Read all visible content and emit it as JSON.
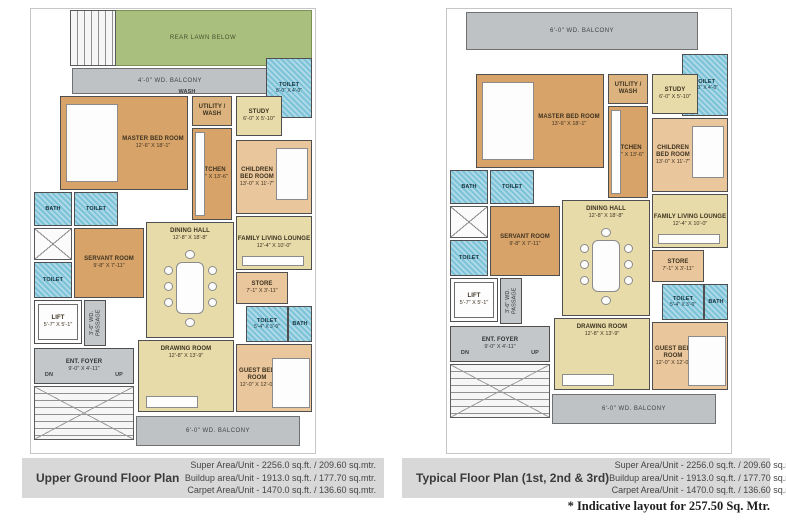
{
  "footnote": "* Indicative layout for 257.50 Sq. Mtr.",
  "colors": {
    "lawn_green": "#a9bf7d",
    "balcony_gray": "#bfc2c4",
    "bedroom_tan": "#d7a369",
    "bedroom_peach": "#eac69c",
    "living_cream": "#e6dba9",
    "toilet_blue": "#7cc2d8",
    "caption_band": "#d8d8d8"
  },
  "plans": [
    {
      "title": "Upper Ground Floor Plan",
      "super_area": "Super Area/Unit - 2256.0 sq.ft. / 209.60 sq.mtr.",
      "buildup_area": "Buildup area/Unit - 1913.0 sq.ft. / 177.70 sq.mtr.",
      "carpet_area": "Carpet Area/Unit - 1470.0 sq.ft. / 136.60 sq.mtr.",
      "rooms": {
        "rear_lawn": {
          "name": "REAR LAWN BELOW"
        },
        "balcony_top": {
          "name": "4'-0\" WD. BALCONY"
        },
        "wash": {
          "name": "WASH"
        },
        "toilet_top": {
          "name": "TOILET",
          "dims": "8'-0\" X 4'-0\""
        },
        "master_bed": {
          "name": "MASTER BED ROOM",
          "dims": "12'-6\" X 18'-1\""
        },
        "utility": {
          "name": "UTILITY / WASH"
        },
        "kitchen": {
          "name": "KITCHEN",
          "dims": "8'-0\" X 13'-6\""
        },
        "study": {
          "name": "STUDY",
          "dims": "6'-0\" X 5'-10\""
        },
        "children_bed": {
          "name": "CHILDREN BED ROOM",
          "dims": "13'-0\" X 11'-7\""
        },
        "family_lounge": {
          "name": "FAMILY LIVING LOUNGE",
          "dims": "12'-4\" X 10'-0\""
        },
        "dining_hall": {
          "name": "DINING HALL",
          "dims": "12'-8\" X 18'-8\""
        },
        "bath_left": {
          "name": "BATH"
        },
        "toilet_left1": {
          "name": "TOILET"
        },
        "toilet_left2": {
          "name": "TOILET"
        },
        "servant_room": {
          "name": "SERVANT ROOM",
          "dims": "9'-8\" X 7'-11\""
        },
        "store": {
          "name": "STORE",
          "dims": "7'-1\" X 3'-11\""
        },
        "toilet_mid": {
          "name": "TOILET",
          "dims": "5'-4\" X 3'-0\""
        },
        "bath_mid": {
          "name": "BATH"
        },
        "lift": {
          "name": "LIFT",
          "dims": "5'-7\" X 5'-1\""
        },
        "passage": {
          "name": "3'-6\" WD. PASSAGE"
        },
        "foyer": {
          "name": "ENT. FOYER",
          "dims": "9'-0\" X 4'-11\""
        },
        "dn": {
          "name": "DN"
        },
        "up": {
          "name": "UP"
        },
        "drawing_room": {
          "name": "DRAWING ROOM",
          "dims": "12'-8\" X 13'-9\""
        },
        "guest_bed": {
          "name": "GUEST BED ROOM",
          "dims": "12'-0\" X 12'-0\""
        },
        "balcony_bottom": {
          "name": "6'-0\" WD. BALCONY"
        }
      }
    },
    {
      "title": "Typical Floor Plan (1st, 2nd & 3rd)",
      "super_area": "Super Area/Unit - 2256.0 sq.ft. / 209.60 sq.mtr.",
      "buildup_area": "Buildup area/Unit - 1913.0 sq.ft. / 177.70 sq.mtr.",
      "carpet_area": "Carpet Area/Unit - 1470.0 sq.ft. / 136.60 sq.mtr.",
      "rooms": {
        "balcony_top": {
          "name": "6'-0\" WD. BALCONY"
        },
        "toilet_top": {
          "name": "TOILET",
          "dims": "8'-0\" X 4'-0\""
        },
        "master_bed": {
          "name": "MASTER BED ROOM",
          "dims": "13'-6\" X 18'-1\""
        },
        "utility": {
          "name": "UTILITY / WASH"
        },
        "kitchen": {
          "name": "KITCHEN",
          "dims": "8'-0\" X 13'-6\""
        },
        "study": {
          "name": "STUDY",
          "dims": "6'-0\" X 5'-10\""
        },
        "children_bed": {
          "name": "CHILDREN BED ROOM",
          "dims": "13'-0\" X 11'-7\""
        },
        "family_lounge": {
          "name": "FAMILY LIVING LOUNGE",
          "dims": "12'-4\" X 10'-0\""
        },
        "dining_hall": {
          "name": "DINING HALL",
          "dims": "12'-8\" X 18'-8\""
        },
        "bath_left": {
          "name": "BATH"
        },
        "toilet_left1": {
          "name": "TOILET"
        },
        "toilet_left2": {
          "name": "TOILET"
        },
        "servant_room": {
          "name": "SERVANT ROOM",
          "dims": "9'-8\" X 7'-11\""
        },
        "store": {
          "name": "STORE",
          "dims": "7'-1\" X 3'-11\""
        },
        "toilet_mid": {
          "name": "TOILET",
          "dims": "5'-4\" X 3'-0\""
        },
        "bath_mid": {
          "name": "BATH"
        },
        "lift": {
          "name": "LIFT",
          "dims": "5'-7\" X 5'-1\""
        },
        "passage": {
          "name": "3'-6\" WD. PASSAGE"
        },
        "foyer": {
          "name": "ENT. FOYER",
          "dims": "9'-0\" X 4'-11\""
        },
        "dn": {
          "name": "DN"
        },
        "up": {
          "name": "UP"
        },
        "drawing_room": {
          "name": "DRAWING ROOM",
          "dims": "12'-8\" X 13'-9\""
        },
        "guest_bed": {
          "name": "GUEST BED ROOM",
          "dims": "12'-0\" X 12'-0\""
        },
        "balcony_bottom": {
          "name": "6'-0\" WD. BALCONY"
        }
      }
    }
  ]
}
